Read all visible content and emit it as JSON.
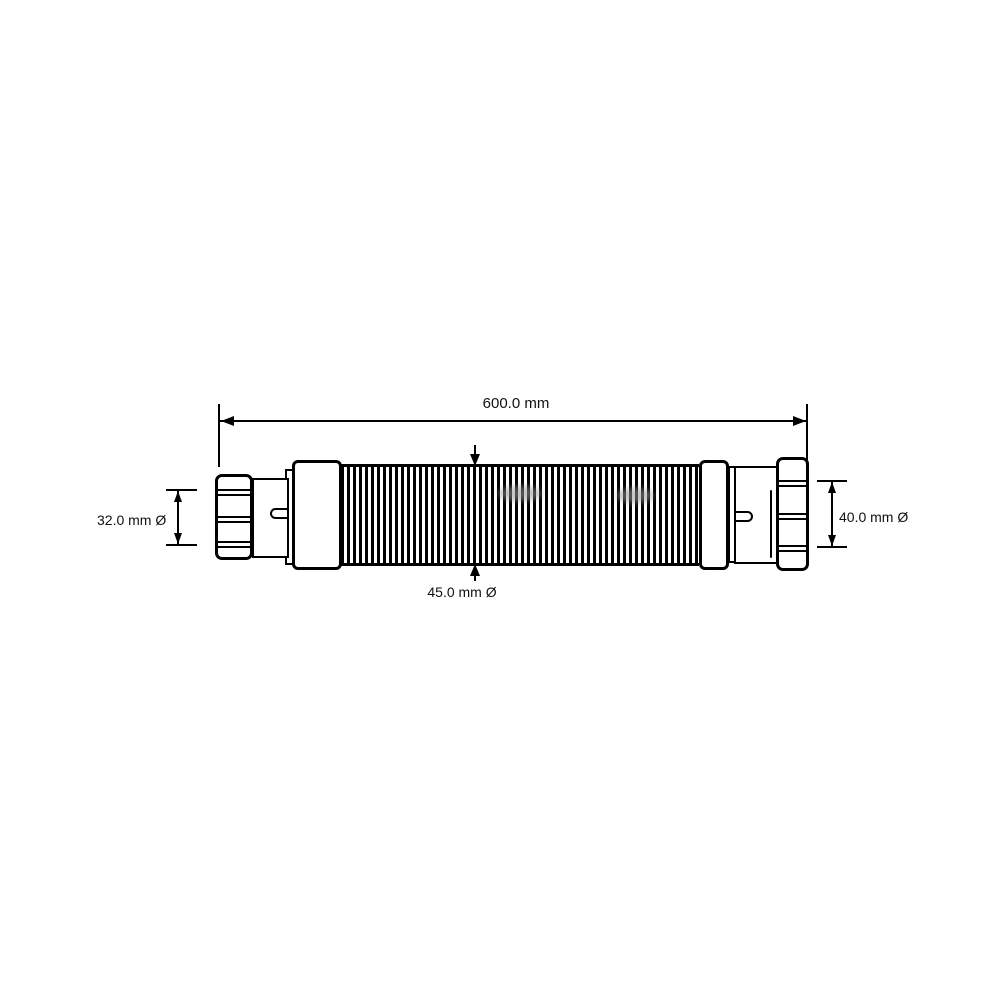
{
  "colors": {
    "background": "#ffffff",
    "line": "#000000",
    "shading": "#999999"
  },
  "dimensions": {
    "overall_length": {
      "label": "600.0 mm"
    },
    "left_diameter": {
      "label": "32.0 mm Ø"
    },
    "right_diameter": {
      "label": "40.0 mm Ø"
    },
    "hose_diameter": {
      "label": "45.0 mm Ø"
    }
  }
}
